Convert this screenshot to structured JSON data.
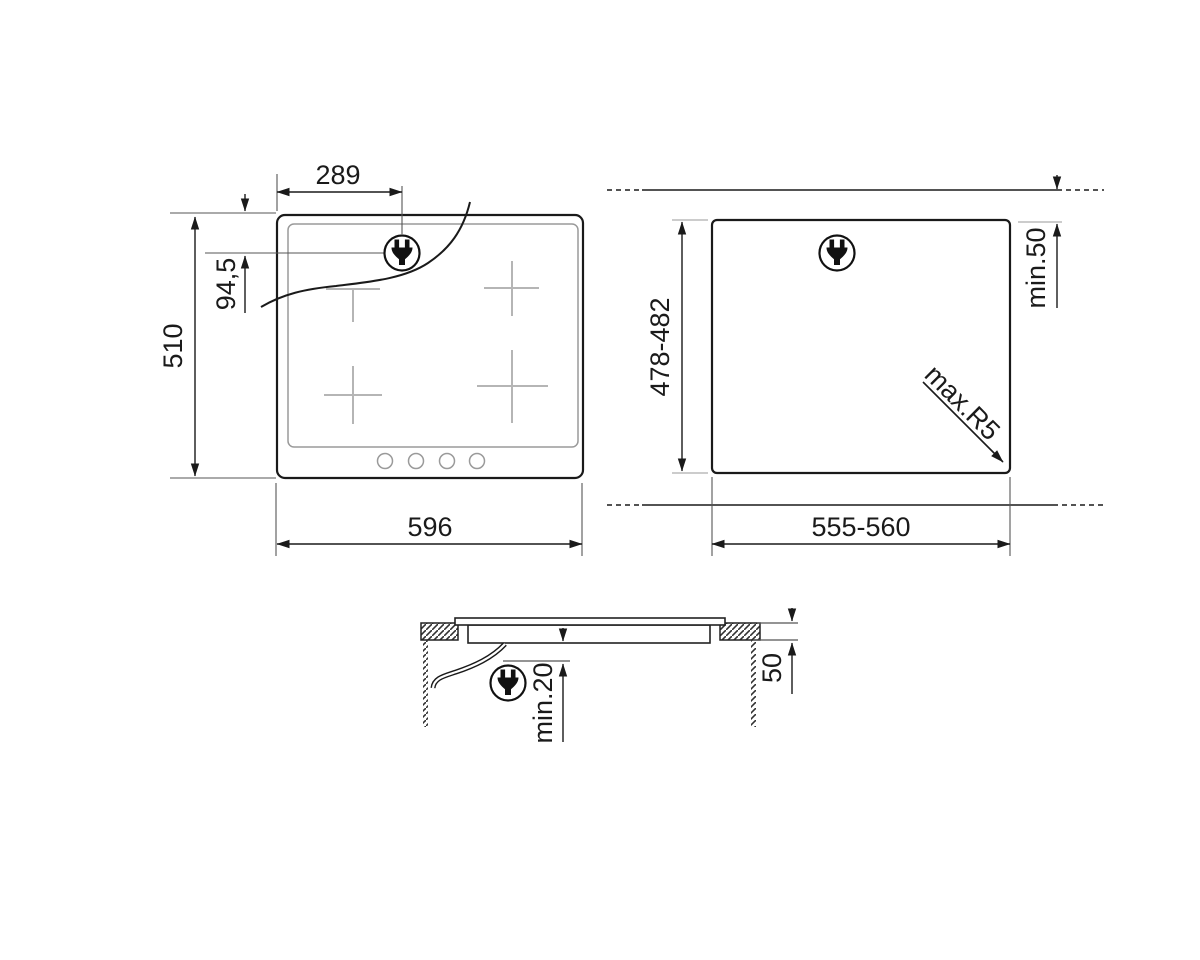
{
  "diagram": {
    "title": "hob-installation-dimensions-drawing",
    "colors": {
      "main_line": "#1a1a1a",
      "aux_line": "#555555",
      "light_line": "#9a9a9a",
      "zone_cross": "#b5b5b5",
      "background": "#ffffff"
    },
    "views": {
      "hob_top_view": "appliance-top-view",
      "cutout_top_view": "worktop-cutout-view",
      "section_view": "installation-side-section"
    },
    "dims": {
      "plug_offset_x": "289",
      "plug_offset_y": "94,5",
      "hob_height": "510",
      "hob_width": "596",
      "cutout_height": "478-482",
      "cutout_width": "555-560",
      "rear_clearance": "min.50",
      "corner_radius": "max.R5",
      "under_clearance": "min.20",
      "worktop_thickness": "50"
    },
    "icons": {
      "plug": "power-plug"
    }
  }
}
